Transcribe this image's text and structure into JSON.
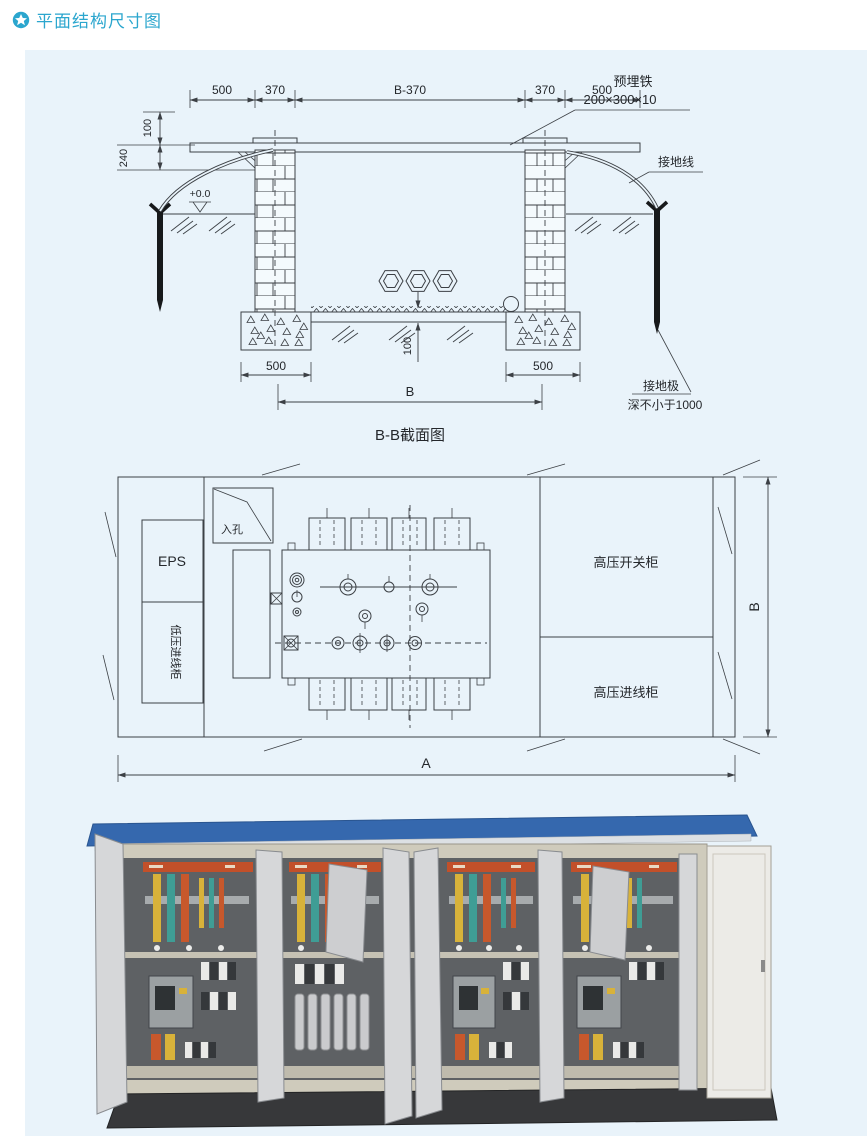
{
  "page": {
    "title": "平面结构尺寸图",
    "accent_color": "#2BA6CE",
    "panel_bg": "#E9F3FA"
  },
  "section_view": {
    "caption": "B-B截面图",
    "dims": {
      "top": [
        "500",
        "370",
        "B-370",
        "370",
        "500"
      ],
      "left_100": "100",
      "left_240": "240",
      "slab_100": "100",
      "footing_left": "500",
      "footing_right": "500",
      "overall": "B"
    },
    "labels": {
      "embed_iron_1": "预埋铁",
      "embed_iron_2": "200×300×10",
      "ground_wire": "接地线",
      "level": "+0.0",
      "electrode_1": "接地极",
      "electrode_2": "深不小于1000"
    }
  },
  "plan_view": {
    "labels": {
      "manhole": "入孔",
      "eps": "EPS",
      "lv_cabinet": "低压进线柜",
      "hv_switch": "高压开关柜",
      "hv_incoming": "高压进线柜"
    },
    "dims": {
      "width_label": "A",
      "depth_label": "B"
    }
  },
  "photo": {
    "colors": {
      "roof": "#3568AE",
      "cabinet": "#CFCBBC",
      "door": "#D6D7D9",
      "plinth": "#37383A",
      "busbar_yellow": "#D8B23A",
      "busbar_teal": "#3F9D95",
      "busbar_orange": "#C7582C"
    }
  }
}
